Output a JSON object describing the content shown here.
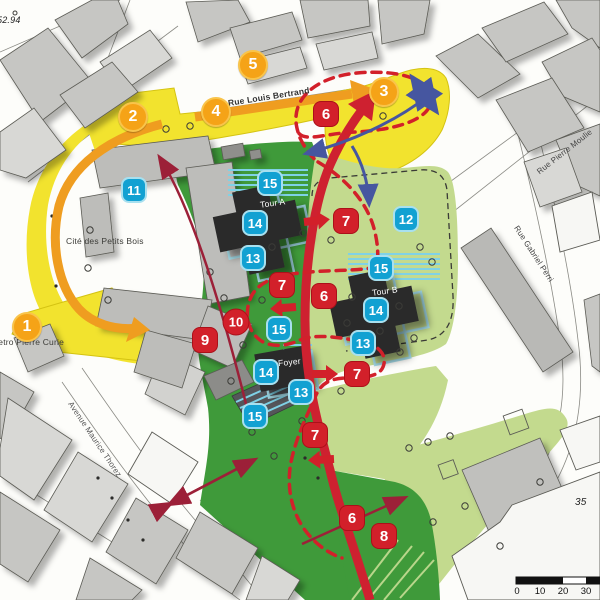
{
  "streets": {
    "louis_bertrand": "Rue Louis Bertrand",
    "pierre_moulie": "Rue Pierre Moulie",
    "gabriel_perri": "Rue Gabriel Perri",
    "maurice_thorez": "Avenue Maurice Thorez"
  },
  "places": {
    "cite": "Cité des Petits Bois",
    "metro": "Metro Pierre Curie",
    "tour_a": "Tour A",
    "tour_b": "Tour B",
    "foyer": "Foyer"
  },
  "elevations": {
    "spot_1": "52.94",
    "spot_2": "35"
  },
  "scale_bar": {
    "tick_labels": [
      "0",
      "10",
      "20",
      "30"
    ]
  },
  "markers": [
    {
      "id": "1",
      "label": "1",
      "type": "orange-circle",
      "x": 27,
      "y": 327
    },
    {
      "id": "2",
      "label": "2",
      "type": "orange-circle",
      "x": 133,
      "y": 117
    },
    {
      "id": "3",
      "label": "3",
      "type": "orange-circle",
      "x": 384,
      "y": 92
    },
    {
      "id": "4",
      "label": "4",
      "type": "orange-circle",
      "x": 216,
      "y": 112
    },
    {
      "id": "5",
      "label": "5",
      "type": "orange-circle",
      "x": 253,
      "y": 65
    },
    {
      "id": "6a",
      "label": "6",
      "type": "red-square",
      "x": 326,
      "y": 114
    },
    {
      "id": "6b",
      "label": "6",
      "type": "red-square",
      "x": 324,
      "y": 296
    },
    {
      "id": "6c",
      "label": "6",
      "type": "red-square",
      "x": 352,
      "y": 518
    },
    {
      "id": "7a",
      "label": "7",
      "type": "red-square",
      "x": 346,
      "y": 221
    },
    {
      "id": "7b",
      "label": "7",
      "type": "red-square",
      "x": 282,
      "y": 285
    },
    {
      "id": "7c",
      "label": "7",
      "type": "red-square",
      "x": 357,
      "y": 374
    },
    {
      "id": "7d",
      "label": "7",
      "type": "red-square",
      "x": 315,
      "y": 435
    },
    {
      "id": "8",
      "label": "8",
      "type": "red-square",
      "x": 384,
      "y": 536
    },
    {
      "id": "9",
      "label": "9",
      "type": "red-square",
      "x": 205,
      "y": 340
    },
    {
      "id": "10",
      "label": "10",
      "type": "red-circle",
      "x": 236,
      "y": 322
    },
    {
      "id": "11",
      "label": "11",
      "type": "cyan-square",
      "x": 134,
      "y": 190
    },
    {
      "id": "12",
      "label": "12",
      "type": "cyan-square",
      "x": 406,
      "y": 219
    },
    {
      "id": "13a",
      "label": "13",
      "type": "cyan-square",
      "x": 253,
      "y": 258
    },
    {
      "id": "13b",
      "label": "13",
      "type": "cyan-square",
      "x": 363,
      "y": 343
    },
    {
      "id": "13c",
      "label": "13",
      "type": "cyan-square",
      "x": 301,
      "y": 392
    },
    {
      "id": "14a",
      "label": "14",
      "type": "cyan-square",
      "x": 255,
      "y": 223
    },
    {
      "id": "14b",
      "label": "14",
      "type": "cyan-square",
      "x": 376,
      "y": 310
    },
    {
      "id": "14c",
      "label": "14",
      "type": "cyan-square",
      "x": 266,
      "y": 372
    },
    {
      "id": "15a",
      "label": "15",
      "type": "cyan-square",
      "x": 270,
      "y": 183
    },
    {
      "id": "15b",
      "label": "15",
      "type": "cyan-square",
      "x": 381,
      "y": 268
    },
    {
      "id": "15c",
      "label": "15",
      "type": "cyan-square",
      "x": 279,
      "y": 329
    },
    {
      "id": "15d",
      "label": "15",
      "type": "cyan-square",
      "x": 255,
      "y": 416
    }
  ],
  "colors": {
    "yellow_zone": "#f2e32e",
    "orange_route": "#ef9d20",
    "red_route": "#ce2130",
    "red_marker": "#d2202a",
    "crimson_arrow": "#9c2038",
    "blue_arrow": "#4656a0",
    "cyan_marker": "#12a1d2",
    "dark_green": "#3f9a3a",
    "light_green": "#c3da8e",
    "building_gray": "#c6c6c3",
    "tower_black": "#2b2b29"
  }
}
